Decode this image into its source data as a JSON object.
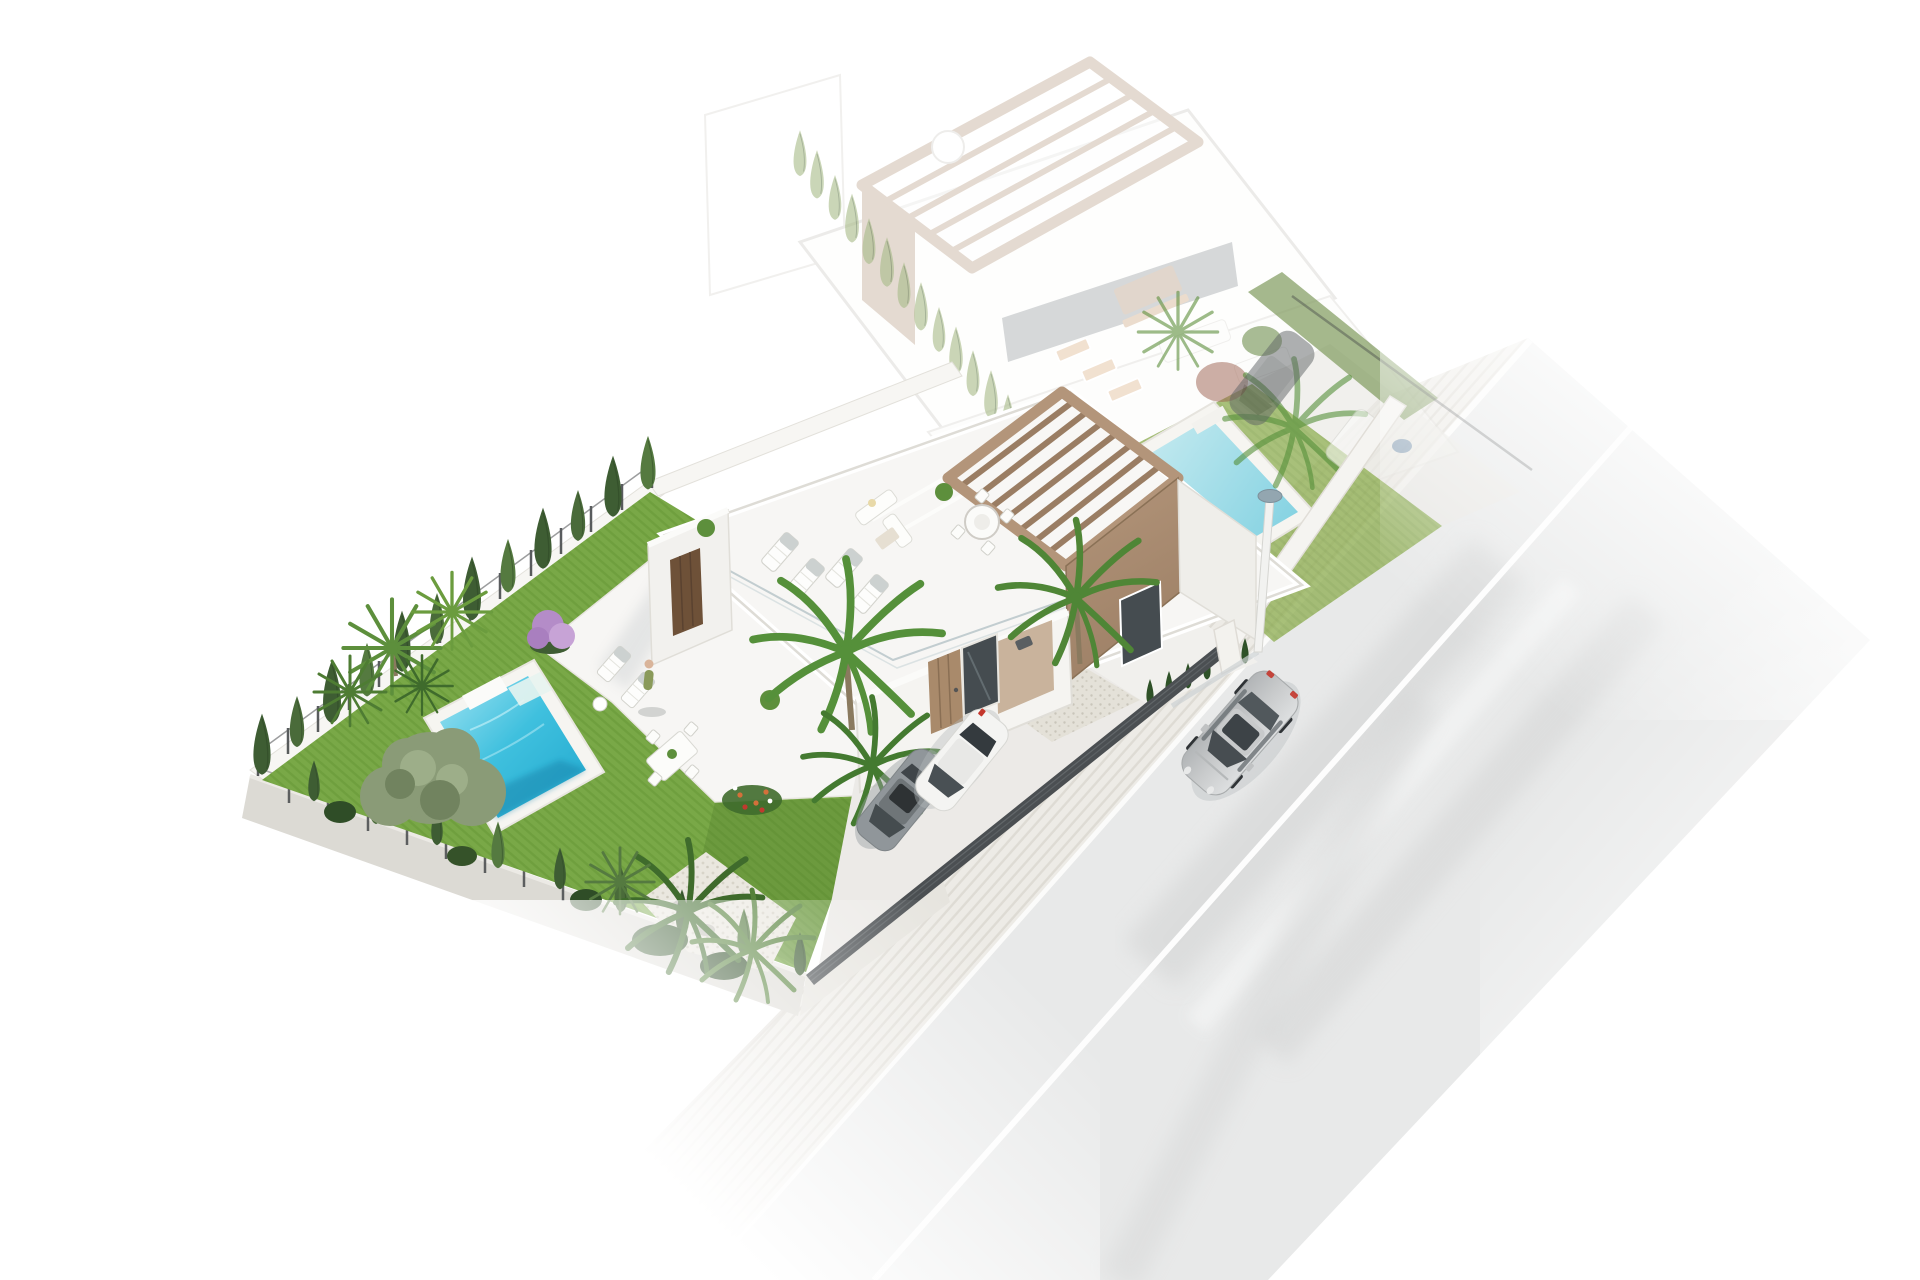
{
  "render": {
    "type": "3d-architectural-site-render",
    "subject": "two detached villas with pools, garden, driveway and street",
    "ghost_plot_opacity": 0.34
  },
  "colors": {
    "bg": "#ffffff",
    "road": "#e8e9e9",
    "road_streak": "#d2d3d3",
    "road_streak_light": "#f2f3f3",
    "road_line": "#ffffff",
    "sidewalk": "#edebe6",
    "sidewalk_stripe": "#dcd8d1",
    "curb_line": "#fbfbfa",
    "wall_white": "#f7f6f3",
    "wall_concrete": "#dcdad4",
    "wall_concrete_light": "#e6e4de",
    "building_white": "#f7f6f4",
    "building_face": "#f5f4f1",
    "parapet": "#dedcd6",
    "glass_rail": "#b9c6c9",
    "wood": "#b3957a",
    "wood_dark": "#9a7d63",
    "wood_edge": "#8a7156",
    "beige_wall": "#c9b39c",
    "door_wood": "#a98a6b",
    "door_dark": "#6e5138",
    "window_dark": "#454c50",
    "lawn": "#79a847",
    "lawn_stripe": "#6d9c3c",
    "lawn_ghost": "#93b159",
    "lawn_shadow": "#4f7a2c",
    "pool_light": "#9fe3f2",
    "pool_mid": "#3fc0de",
    "pool_deep": "#1ea6cd",
    "pool_ghost_light": "#c2e9ef",
    "pool_ghost_deep": "#7ccfe0",
    "coping": "#f6f5f1",
    "cypress": "#3e5d33",
    "cypress_light": "#4a6b3a",
    "cypress_bright": "#557a40",
    "hedge_ghost": "#a8bb88",
    "palm": "#55903a",
    "palm_dark": "#3f6b2c",
    "fan_palm": "#5d8f3c",
    "olive": "#8a9b77",
    "olive_light": "#9dae89",
    "olive_dark": "#71835f",
    "trunk": "#8a7a5f",
    "purple_bloom": "#b48cc8",
    "flower_orange": "#d4703a",
    "flower_red": "#c03a2e",
    "fence_dark": "#3d4042",
    "gate": "#4b4f52",
    "gate_slat": "#686d70",
    "gravel": "#e4e1d8",
    "pebble": "#eae7df",
    "driveway": "#eceae7",
    "car_silver": "#c9cbcc",
    "car_silver_dark": "#b2b5b7",
    "car_white": "#f4f4f2",
    "car_gray": "#90969a",
    "car_ghost": "#5f6466",
    "car_window": "#3f4549",
    "taillight": "#c4362c",
    "lamp_head": "#93a6b0",
    "shadow": "#c2c7ca"
  },
  "scene_objects": [
    "road",
    "sidewalk",
    "street-lamp",
    "driving-car",
    "ghost-villa",
    "ghost-pergola",
    "ghost-roof-terrace",
    "ghost-lawn",
    "ghost-pool",
    "ghost-hedge",
    "ghost-car",
    "main-villa",
    "roof-terrace",
    "pergola",
    "sun-loungers",
    "outdoor-sofa",
    "round-dining-table",
    "entrance-door",
    "entrance-window",
    "garden-lawn",
    "swimming-pool",
    "pool-steps",
    "cypress-hedge",
    "fan-palms",
    "feather-palms",
    "olive-tree",
    "purple-shrub",
    "flower-bed",
    "gravel-patch",
    "pebble-patch",
    "perimeter-wall",
    "metal-fence",
    "driveway",
    "entrance-gate",
    "parked-white-car",
    "parked-gray-car",
    "person"
  ]
}
